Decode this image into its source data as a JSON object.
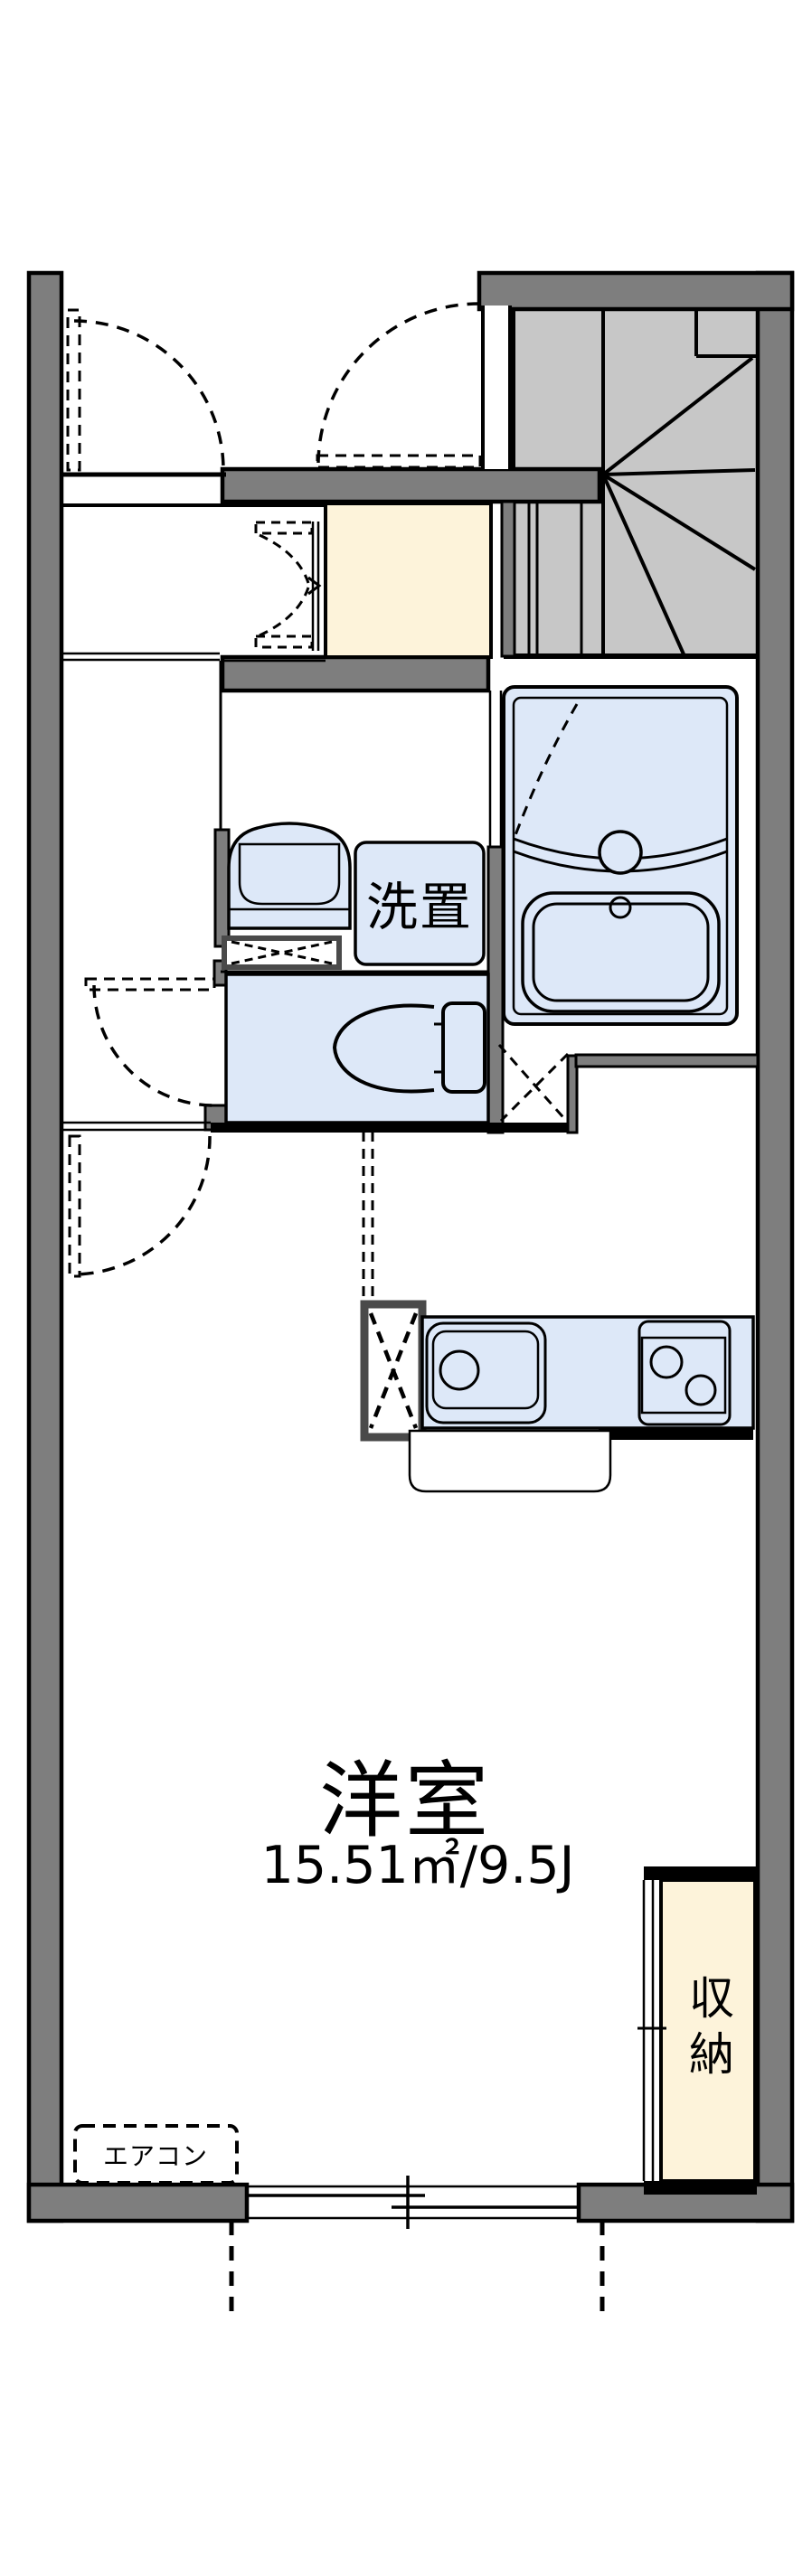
{
  "plan": {
    "type": "floorplan",
    "rooms": {
      "main_room": {
        "name": "洋室",
        "area": "15.51㎡/9.5J"
      },
      "washstand": {
        "name": "洗置"
      },
      "storage": {
        "name": "収納"
      },
      "aircon": {
        "name": "エアコン"
      }
    }
  },
  "colors": {
    "wall": "#7e7e7e",
    "stair": "#c7c7c7",
    "tile": "#fdf3da",
    "fixture": "#dde8f8"
  }
}
